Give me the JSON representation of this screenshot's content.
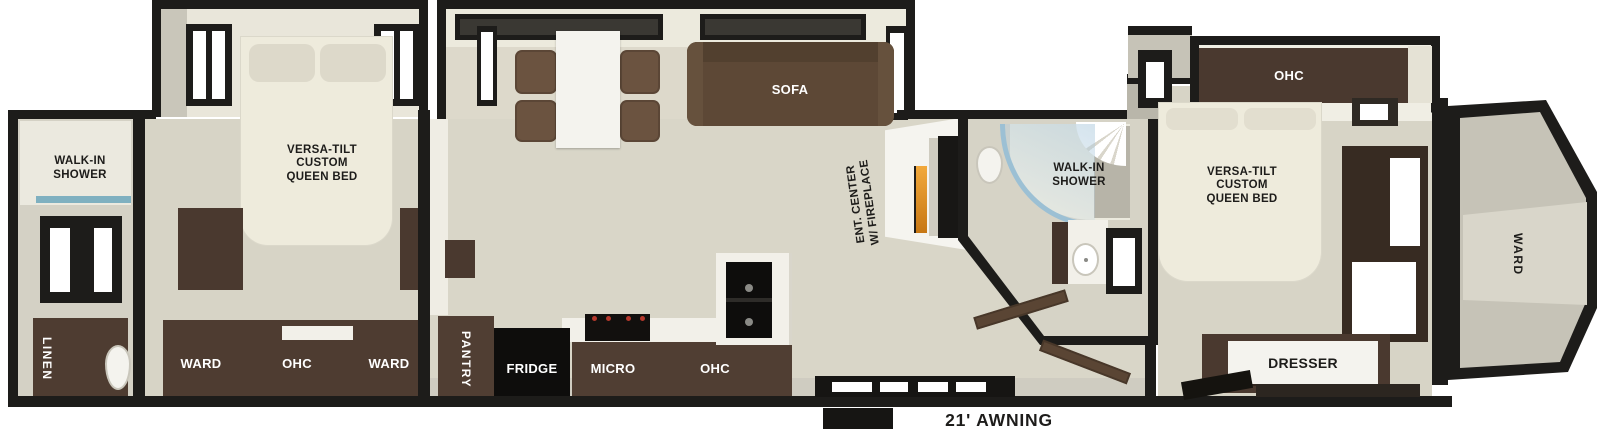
{
  "floorplan": {
    "awning": "21' AWNING",
    "rear_bath": {
      "shower": "WALK-IN\nSHOWER",
      "linen": "LINEN"
    },
    "rear_bedroom": {
      "bed": "VERSA-TILT\nCUSTOM\nQUEEN BED",
      "ward_left": "WARD",
      "ohc": "OHC",
      "ward_right": "WARD"
    },
    "living": {
      "sofa": "SOFA",
      "ent_center": "ENT. CENTER\nW/ FIREPLACE"
    },
    "kitchen": {
      "pantry": "PANTRY",
      "fridge": "FRIDGE",
      "micro": "MICRO",
      "ohc": "OHC"
    },
    "mid_bath": {
      "shower": "WALK-IN\nSHOWER"
    },
    "front_bedroom": {
      "ohc": "OHC",
      "bed": "VERSA-TILT\nCUSTOM\nQUEEN BED",
      "dresser": "DRESSER"
    },
    "front_cap": {
      "ward": "WARD"
    },
    "colors": {
      "wall": "#1d1c1a",
      "floor": "#d8d5c7",
      "slide_interior": "#e9e6da",
      "cabinet": "#4a392f",
      "cabinet_dark": "#3c2e26",
      "sofa": "#5d4836",
      "bed": "#eeebdc",
      "shower_glass": "#9cc0d4",
      "fireplace": "#e08a1e",
      "appliance": "#0e0d0c",
      "counter": "#f2f0e9",
      "exterior_gray": "#c6c3b7"
    }
  }
}
